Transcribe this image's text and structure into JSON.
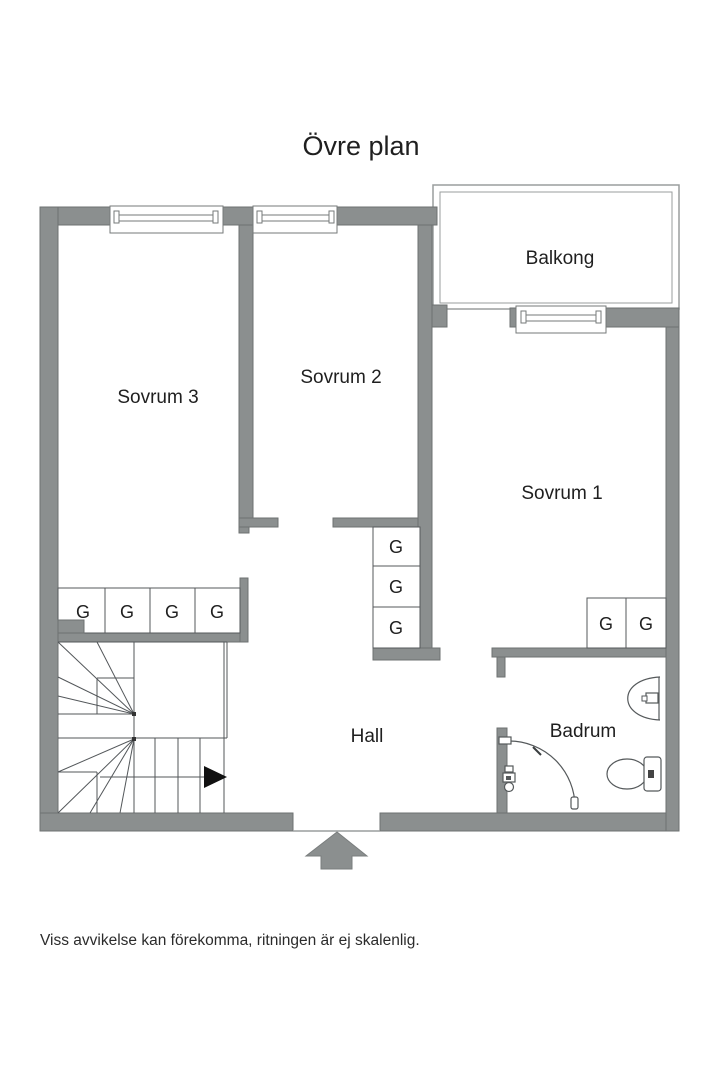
{
  "title": "Övre plan",
  "floorplan": {
    "rooms": [
      {
        "id": "sovrum3",
        "label": "Sovrum 3"
      },
      {
        "id": "sovrum2",
        "label": "Sovrum 2"
      },
      {
        "id": "sovrum1",
        "label": "Sovrum 1"
      },
      {
        "id": "balkong",
        "label": "Balkong"
      },
      {
        "id": "hall",
        "label": "Hall"
      },
      {
        "id": "badrum",
        "label": "Badrum"
      }
    ],
    "wardrobe_label": "G",
    "wardrobe_groups": [
      {
        "location": "sovrum3-south-wall",
        "count": 4
      },
      {
        "location": "hall-closet-column",
        "count": 3
      },
      {
        "location": "sovrum1-south-wall",
        "count": 2
      }
    ],
    "colors": {
      "wall": "#8b8f8f",
      "line": "#53575a",
      "text": "#1f1f1f"
    }
  },
  "footer": {
    "disclaimer": "Viss avvikelse kan förekomma, ritningen är ej skalenlig."
  }
}
